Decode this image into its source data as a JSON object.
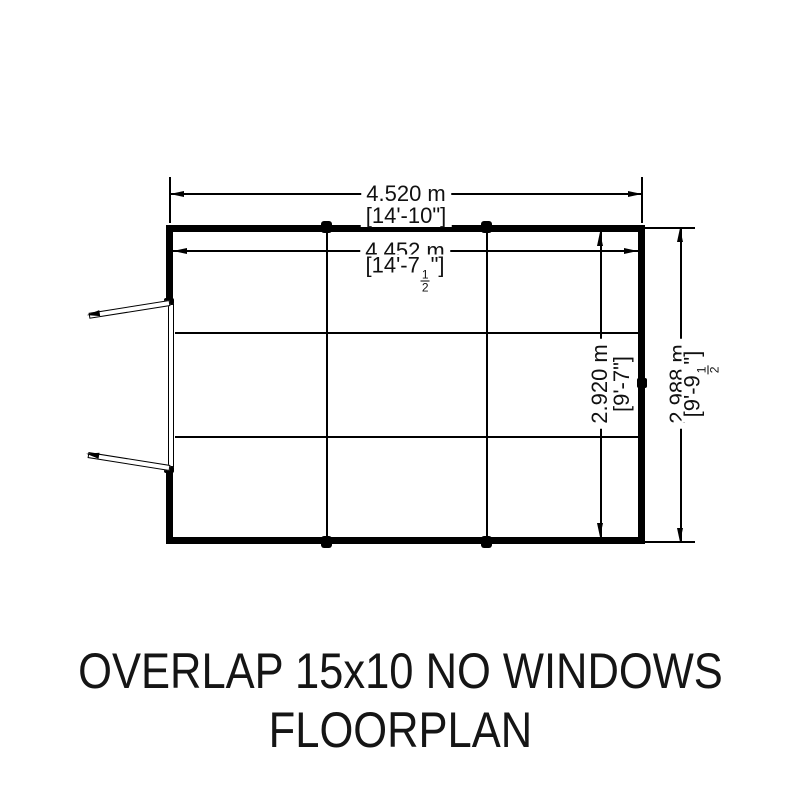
{
  "drawing": {
    "title_line1": "OVERLAP 15x10 NO WINDOWS",
    "title_line2": "FLOORPLAN",
    "dims": {
      "outer_width": {
        "metric": "4.520 m",
        "imp_pre": "[14'-10\"]",
        "imp_num": "",
        "imp_den": "",
        "imp_post": ""
      },
      "inner_width": {
        "metric": "4.452 m",
        "imp_pre": "[14'-7",
        "imp_num": "1",
        "imp_den": "2",
        "imp_post": "\"]"
      },
      "inner_depth": {
        "metric": "2.920 m",
        "imp_pre": "[9'-7\"]",
        "imp_num": "",
        "imp_den": "",
        "imp_post": ""
      },
      "outer_depth": {
        "metric": "2.988 m",
        "imp_pre": "[9'-9",
        "imp_num": "1",
        "imp_den": "2",
        "imp_post": "\"]"
      }
    },
    "colors": {
      "line": "#000000",
      "background": "#ffffff",
      "text": "#151515"
    }
  }
}
